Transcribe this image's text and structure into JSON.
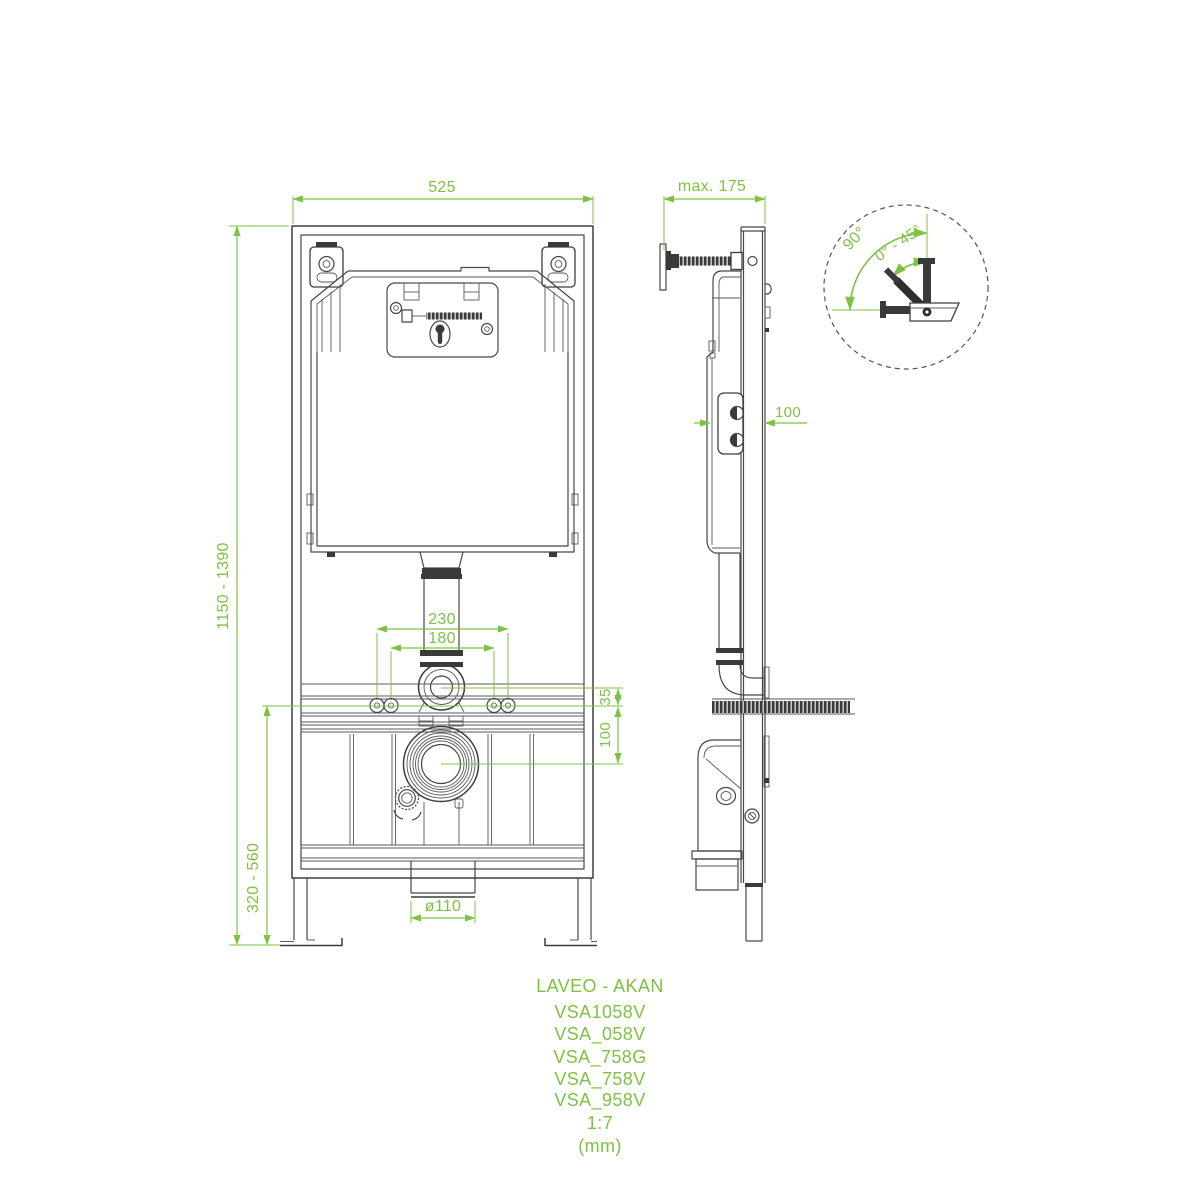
{
  "drawing": {
    "brand_series": "LAVEO - AKAN",
    "models": [
      "VSA1058V",
      "VSA_058V",
      "VSA_758G",
      "VSA_758V",
      "VSA_958V"
    ],
    "scale": "1:7",
    "units": "(mm)",
    "colors": {
      "dimension_green": "#7EC242",
      "line_art": "#474747",
      "background": "#FFFFFF"
    },
    "front_view": {
      "overall_width": "525",
      "overall_height_range": "1150 - 1390",
      "fixing_span_outer": "230",
      "fixing_span_inner": "180",
      "flush_pipe_offset": "35",
      "drain_offset": "100",
      "lower_height_range": "320 - 560",
      "outlet_diameter": "ø110"
    },
    "side_view": {
      "max_depth": "max. 175",
      "wall_clearance": "100"
    },
    "detail_view": {
      "mount_angle_max": "90°",
      "mount_angle_range": "0° - 45°"
    }
  }
}
